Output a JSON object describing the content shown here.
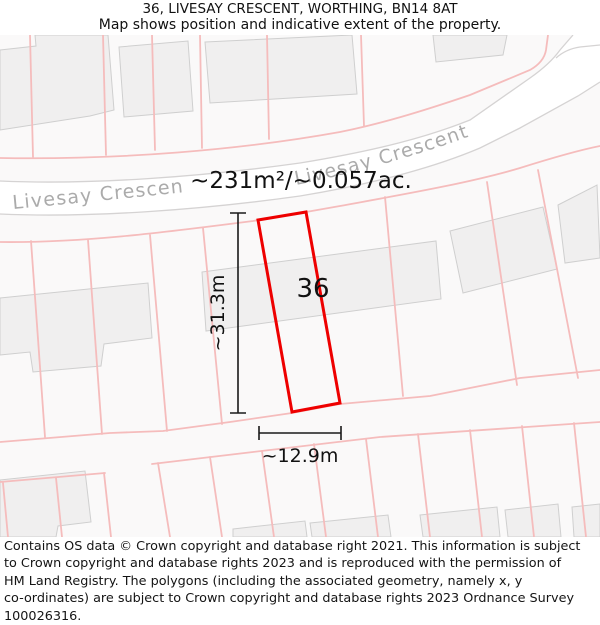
{
  "header": {
    "title": "36, LIVESAY CRESCENT, WORTHING, BN14 8AT",
    "subtitle": "Map shows position and indicative extent of the property."
  },
  "map": {
    "street_label": "Livesay Crescent",
    "area_label": "~231m²/~0.057ac.",
    "plot_label": "36",
    "dim_height": "~31.3m",
    "dim_width": "~12.9m",
    "colors": {
      "highlight_outline": "#ee0000",
      "parcel_line": "#f5bcbc",
      "building_fill": "#f0efef",
      "building_stroke": "#cfcfcf",
      "street_border": "#d5d3d3",
      "street_label_text": "#ababab",
      "background": "#faf9f9"
    }
  },
  "footer": {
    "lines": [
      "Contains OS data © Crown copyright and database right 2021. This information is subject",
      "to Crown copyright and database rights 2023 and is reproduced with the permission of",
      "HM Land Registry. The polygons (including the associated geometry, namely x, y",
      "co-ordinates) are subject to Crown copyright and database rights 2023 Ordnance Survey",
      "100026316."
    ]
  }
}
